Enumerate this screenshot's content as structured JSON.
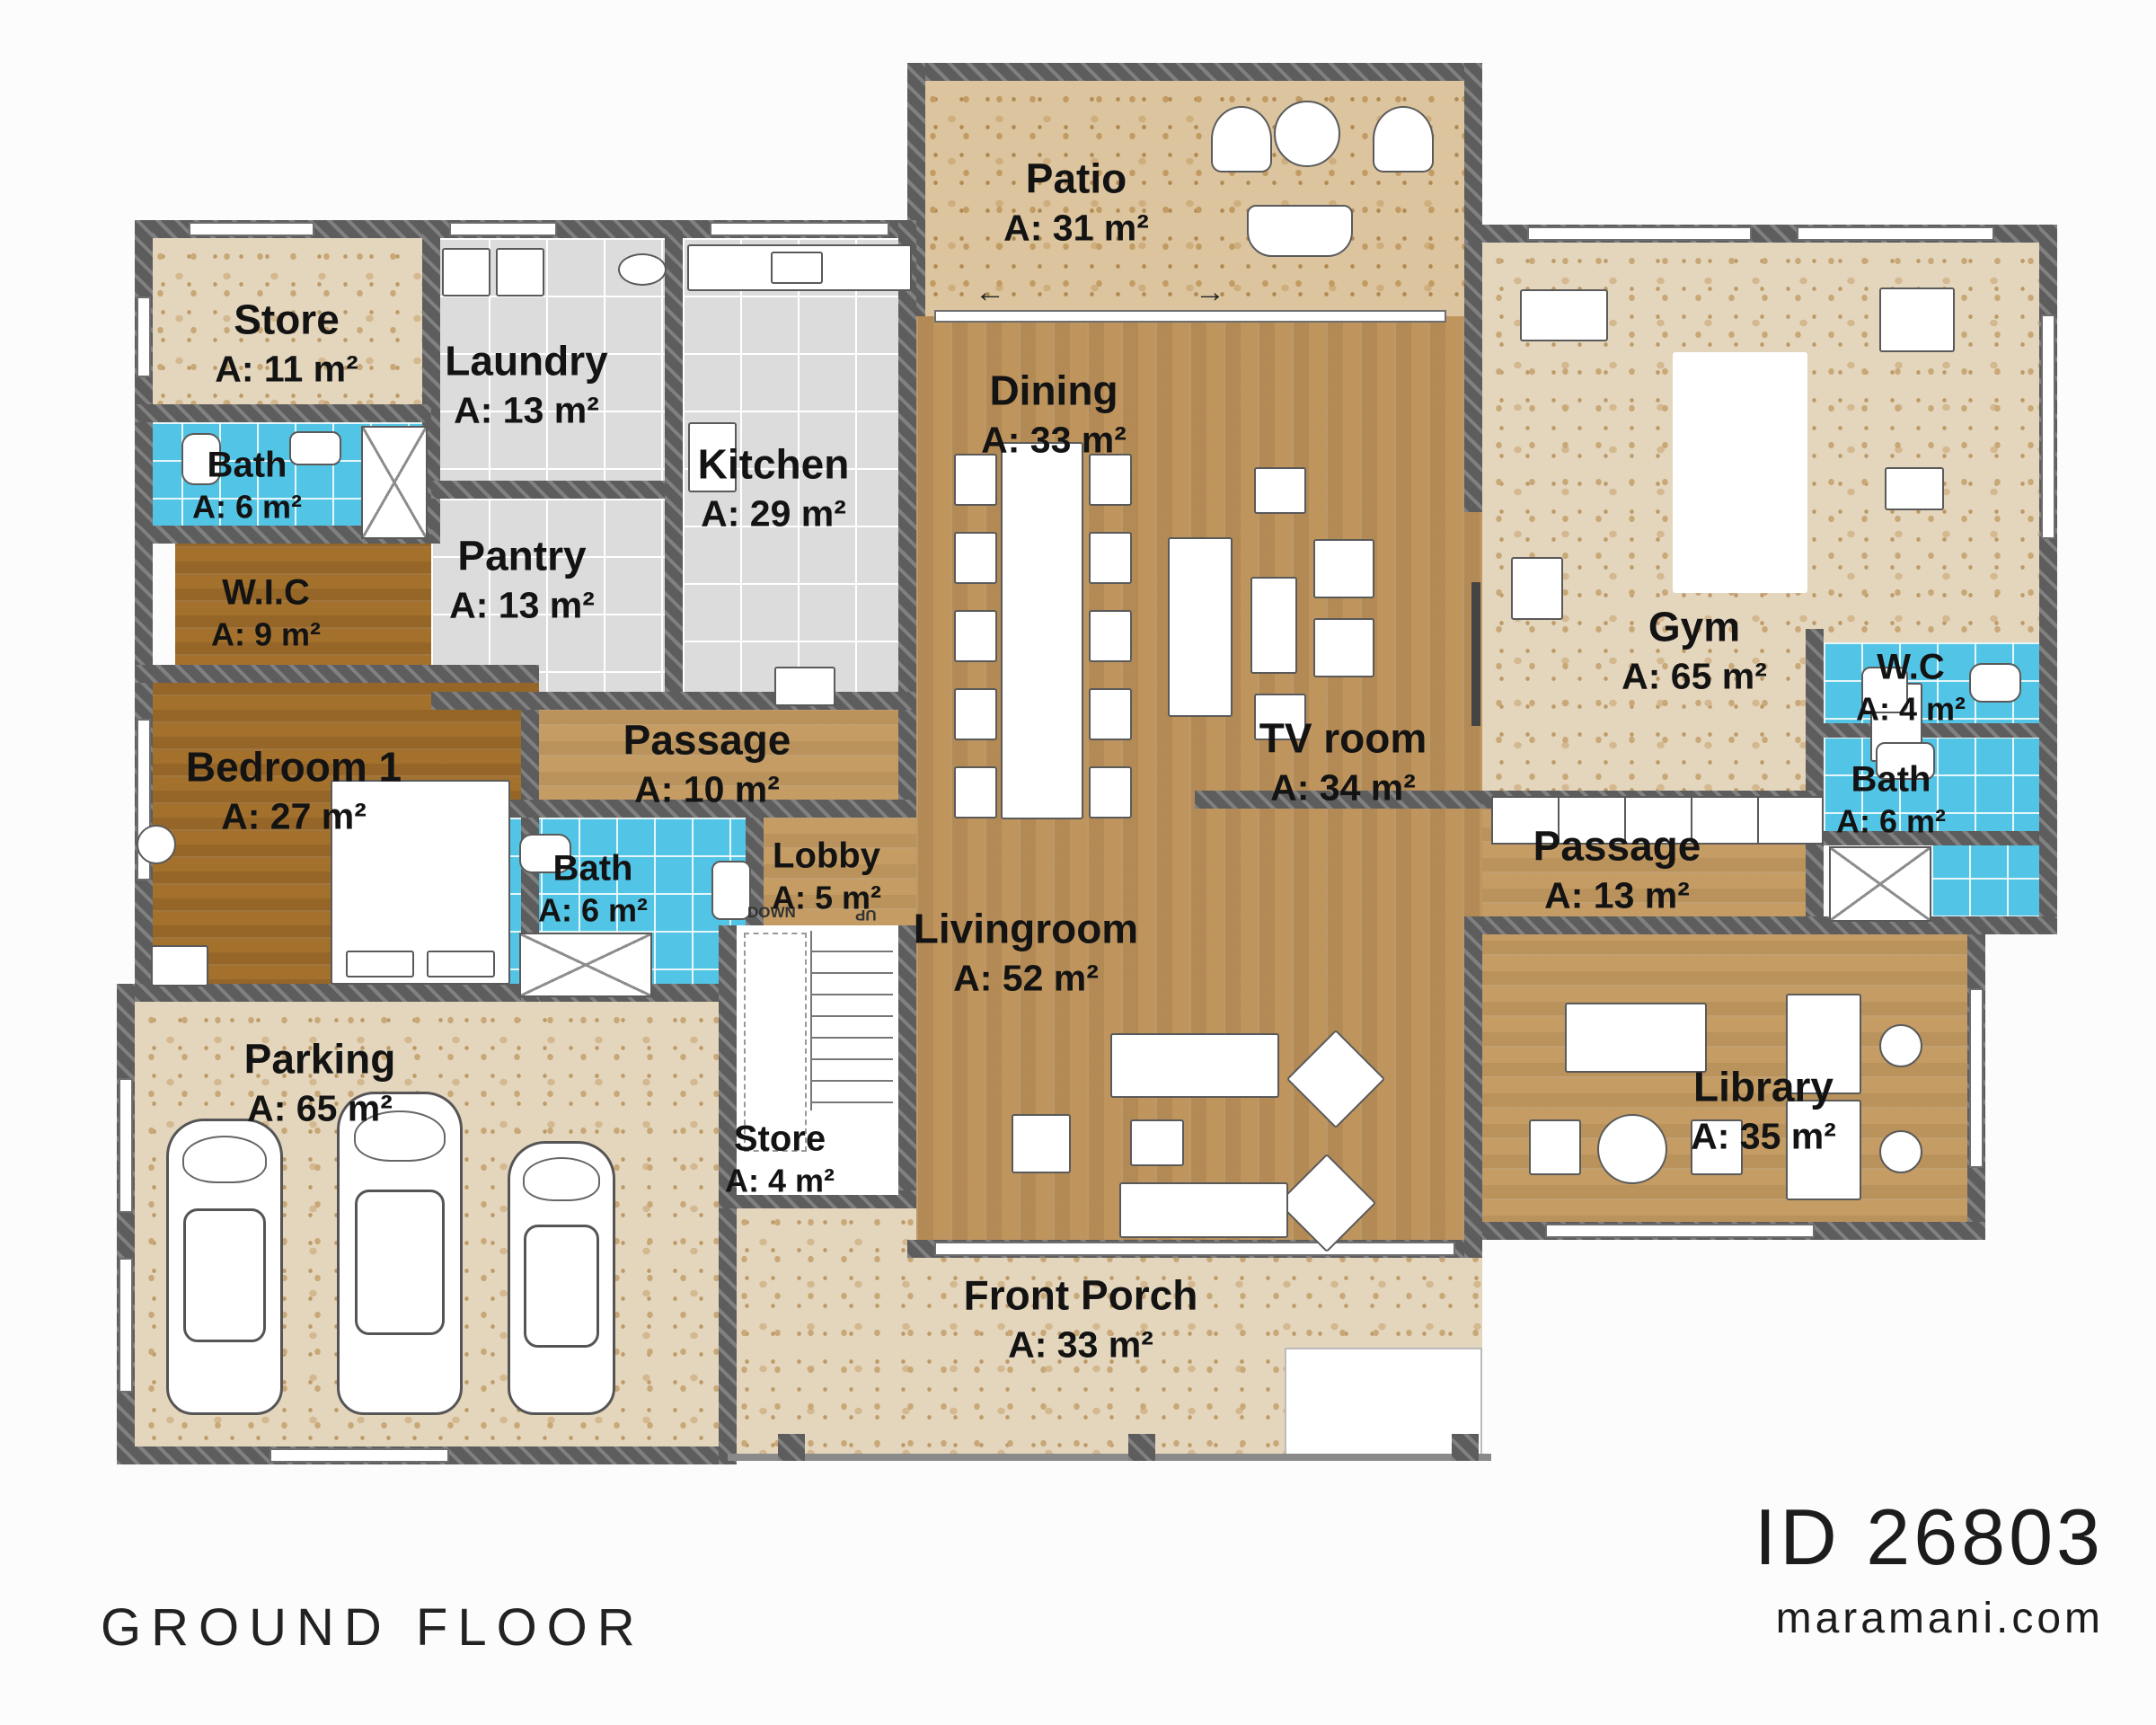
{
  "title": {
    "floor_label": "GROUND FLOOR"
  },
  "brand": {
    "plan_id": "ID 26803",
    "website": "maramani.com"
  },
  "stairs": {
    "down": "DOWN",
    "up": "UP"
  },
  "arrows": {
    "left": "←",
    "right": "→"
  },
  "colors": {
    "wall": "#5d5d5d",
    "blue_tile": "#52c5e6",
    "gray_tile": "#dcdcdc",
    "wood_light": "#c9a169",
    "wood_dark": "#a8742f",
    "terrazzo": "#e4d6bd",
    "background": "#fcfcfc"
  },
  "rooms": [
    {
      "id": "store-1",
      "name": "Store",
      "area": "A: 11 m²"
    },
    {
      "id": "laundry",
      "name": "Laundry",
      "area": "A: 13 m²"
    },
    {
      "id": "kitchen",
      "name": "Kitchen",
      "area": "A: 29 m²"
    },
    {
      "id": "pantry",
      "name": "Pantry",
      "area": "A: 13 m²"
    },
    {
      "id": "bath-left",
      "name": "Bath",
      "area": "A: 6 m²"
    },
    {
      "id": "wic",
      "name": "W.I.C",
      "area": "A: 9 m²"
    },
    {
      "id": "bedroom-1",
      "name": "Bedroom 1",
      "area": "A: 27 m²"
    },
    {
      "id": "passage-left",
      "name": "Passage",
      "area": "A: 10 m²"
    },
    {
      "id": "bath-mid",
      "name": "Bath",
      "area": "A: 6 m²"
    },
    {
      "id": "lobby",
      "name": "Lobby",
      "area": "A: 5 m²"
    },
    {
      "id": "patio",
      "name": "Patio",
      "area": "A: 31 m²"
    },
    {
      "id": "dining",
      "name": "Dining",
      "area": "A: 33 m²"
    },
    {
      "id": "tv-room",
      "name": "TV room",
      "area": "A: 34 m²"
    },
    {
      "id": "gym",
      "name": "Gym",
      "area": "A: 65 m²"
    },
    {
      "id": "wc-right",
      "name": "W.C",
      "area": "A: 4 m²"
    },
    {
      "id": "bath-right",
      "name": "Bath",
      "area": "A: 6 m²"
    },
    {
      "id": "passage-right",
      "name": "Passage",
      "area": "A: 13 m²"
    },
    {
      "id": "library",
      "name": "Library",
      "area": "A: 35 m²"
    },
    {
      "id": "livingroom",
      "name": "Livingroom",
      "area": "A: 52 m²"
    },
    {
      "id": "parking",
      "name": "Parking",
      "area": "A: 65 m²"
    },
    {
      "id": "store-2",
      "name": "Store",
      "area": "A: 4 m²"
    },
    {
      "id": "front-porch",
      "name": "Front Porch",
      "area": "A: 33 m²"
    }
  ]
}
